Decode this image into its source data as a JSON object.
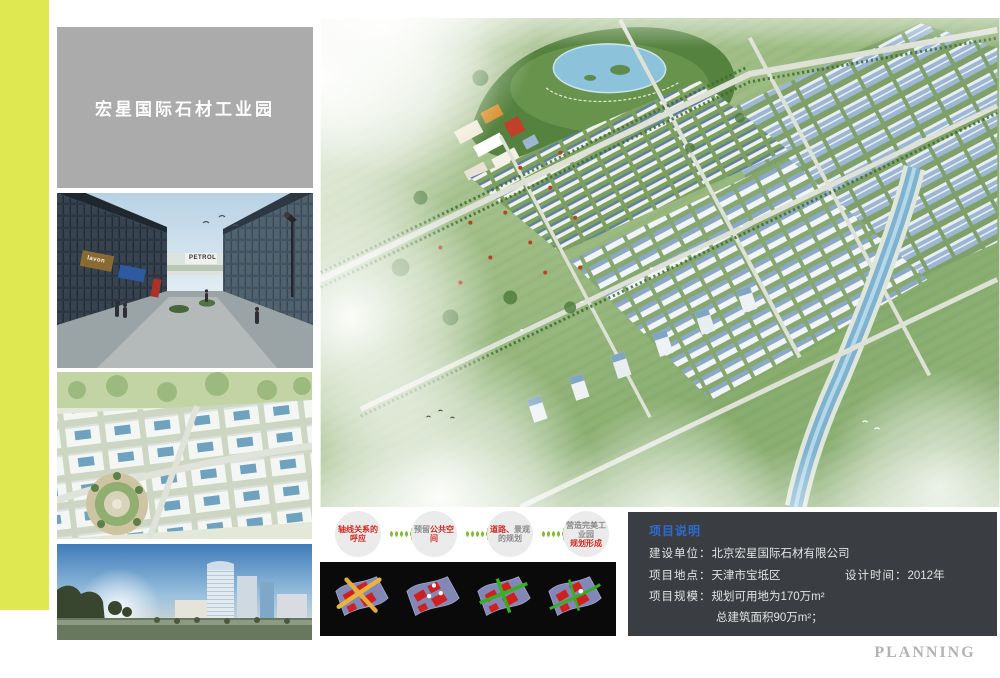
{
  "title_panel": {
    "text": "宏星国际石材工业园"
  },
  "photos": {
    "street": {
      "signs": [
        "lavon",
        "PETROL"
      ]
    }
  },
  "process": {
    "steps": [
      {
        "pre": "",
        "main": "轴线关系的呼应",
        "tail": "",
        "line2": ""
      },
      {
        "pre": "预留",
        "main": "公共空间",
        "tail": "",
        "line2": ""
      },
      {
        "pre": "",
        "main": "道路、",
        "tail": "景观的规划",
        "line2": ""
      },
      {
        "pre": "",
        "main": "",
        "tail": "营造完美工业园",
        "line2": "规划形成"
      }
    ]
  },
  "info_panel": {
    "header": "项目说明",
    "rows": [
      {
        "label": "建设单位：",
        "value": "北京宏星国际石材有限公司",
        "right_label": "",
        "right_value": ""
      },
      {
        "label": "项目地点：",
        "value": "天津市宝坻区",
        "right_label": "设计时间：",
        "right_value": "2012年"
      },
      {
        "label": "项目规模：",
        "value": "规划可用地为170万m²",
        "right_label": "",
        "right_value": ""
      },
      {
        "label": "",
        "value": "总建筑面积90万m²；",
        "right_label": "",
        "right_value": ""
      }
    ]
  },
  "watermark": "PLANNING",
  "colors": {
    "accent_stripe": "#dfe751",
    "title_bg": "#ababab",
    "info_bg": "#3a3d41",
    "info_header_blue": "#2e6ad1",
    "arrow_green": "#7fbe26",
    "step_red": "#cf2b24"
  }
}
